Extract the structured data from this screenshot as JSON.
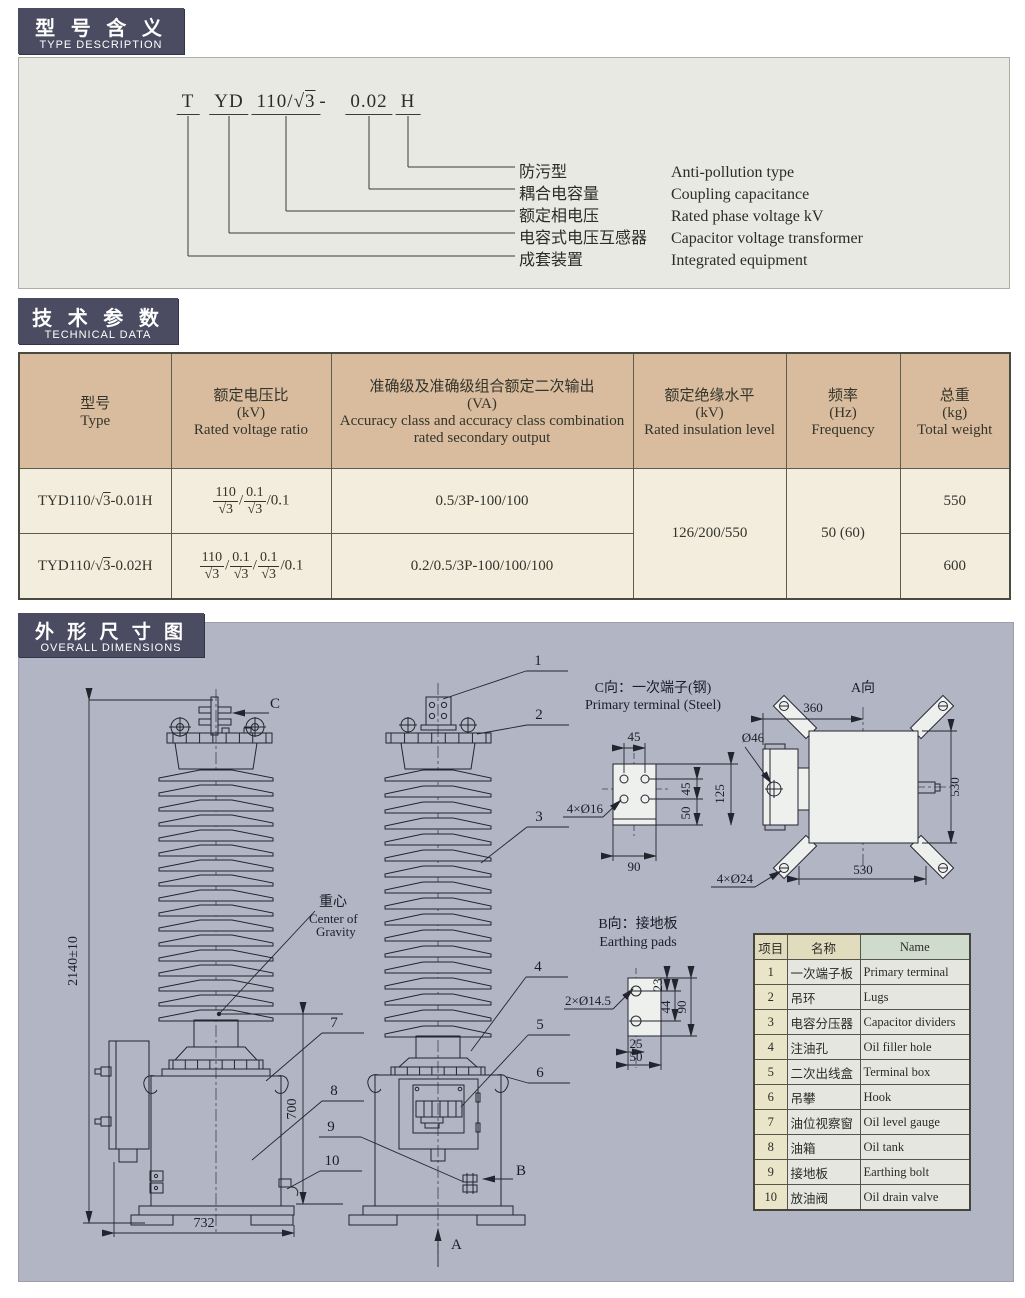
{
  "sections": {
    "type_desc": {
      "title_zh": "型 号 含 义",
      "title_en": "TYPE DESCRIPTION"
    },
    "tech": {
      "title_zh": "技 术 参 数",
      "title_en": "TECHNICAL DATA"
    },
    "dims": {
      "title_zh": "外 形 尺 寸 图",
      "title_en": "OVERALL DIMENSIONS"
    }
  },
  "type_code": {
    "tokens": [
      "T",
      "YD",
      "110/√3",
      "-",
      "0.02",
      "H"
    ],
    "meanings": [
      {
        "zh": "防污型",
        "en": "Anti-pollution type"
      },
      {
        "zh": "耦合电容量",
        "en": "Coupling capacitance"
      },
      {
        "zh": "额定相电压",
        "en": "Rated phase voltage kV"
      },
      {
        "zh": "电容式电压互感器",
        "en": "Capacitor voltage transformer"
      },
      {
        "zh": "成套装置",
        "en": "Integrated equipment"
      }
    ]
  },
  "tech_table": {
    "headers": [
      {
        "zh": "型号",
        "unit": "",
        "en": "Type"
      },
      {
        "zh": "额定电压比",
        "unit": "(kV)",
        "en": "Rated voltage ratio"
      },
      {
        "zh": "准确级及准确级组合额定二次输出",
        "unit": "(VA)",
        "en": "Accuracy class and accuracy class combination rated secondary output"
      },
      {
        "zh": "额定绝缘水平",
        "unit": "(kV)",
        "en": "Rated insulation level"
      },
      {
        "zh": "频率",
        "unit": "(Hz)",
        "en": "Frequency"
      },
      {
        "zh": "总重",
        "unit": "(kg)",
        "en": "Total weight"
      }
    ],
    "rows": [
      {
        "type": "TYD110/√3-0.01H",
        "ratio_tokens": [
          {
            "frac": [
              "110",
              "√3"
            ]
          },
          {
            "text": "/"
          },
          {
            "frac": [
              "0.1",
              "√3"
            ]
          },
          {
            "text": "/0.1"
          }
        ],
        "output": "0.5/3P-100/100",
        "weight": "550"
      },
      {
        "type": "TYD110/√3-0.02H",
        "ratio_tokens": [
          {
            "frac": [
              "110",
              "√3"
            ]
          },
          {
            "text": "/"
          },
          {
            "frac": [
              "0.1",
              "√3"
            ]
          },
          {
            "text": "/"
          },
          {
            "frac": [
              "0.1",
              "√3"
            ]
          },
          {
            "text": "/0.1"
          }
        ],
        "output": "0.2/0.5/3P-100/100/100",
        "weight": "600"
      }
    ],
    "insulation": "126/200/550",
    "frequency": "50 (60)"
  },
  "drawing": {
    "labels": {
      "c_title_zh": "C向：一次端子(钢)",
      "c_title_en": "Primary terminal (Steel)",
      "a_view": "A向",
      "b_title_zh": "B向：接地板",
      "b_title_en": "Earthing pads",
      "cg_zh": "重心",
      "cg_en1": "Center of",
      "cg_en2": "Gravity",
      "c_arrow": "C",
      "a_arrow": "A",
      "b_arrow": "B"
    },
    "dims": {
      "overall_height": "2140±10",
      "tank_height": "700",
      "base_width": "732",
      "c_top": "45",
      "c_bottom": "90",
      "c_v45": "45",
      "c_v50": "50",
      "c_v125": "125",
      "c_holes": "4×Ø16",
      "a_360": "360",
      "a_530r": "530",
      "a_530b": "530",
      "a_holes": "4×Ø24",
      "a_boss": "Ø46",
      "b_holes": "2×Ø14.5",
      "b_23": "23",
      "b_44": "44",
      "b_90": "90",
      "b_25": "25",
      "b_50": "50"
    },
    "callouts": [
      "1",
      "2",
      "3",
      "4",
      "5",
      "6",
      "7",
      "8",
      "9",
      "10"
    ]
  },
  "parts_table": {
    "headers": {
      "col1": "项目",
      "col2": "名称",
      "col3": "Name"
    },
    "rows": [
      {
        "no": "1",
        "zh": "一次端子板",
        "en": "Primary terminal"
      },
      {
        "no": "2",
        "zh": "吊环",
        "en": "Lugs"
      },
      {
        "no": "3",
        "zh": "电容分压器",
        "en": "Capacitor dividers"
      },
      {
        "no": "4",
        "zh": "注油孔",
        "en": "Oil filler hole"
      },
      {
        "no": "5",
        "zh": "二次出线盒",
        "en": "Terminal box"
      },
      {
        "no": "6",
        "zh": "吊攀",
        "en": "Hook"
      },
      {
        "no": "7",
        "zh": "油位视察窗",
        "en": "Oil level gauge"
      },
      {
        "no": "8",
        "zh": "油箱",
        "en": "Oil tank"
      },
      {
        "no": "9",
        "zh": "接地板",
        "en": "Earthing bolt"
      },
      {
        "no": "10",
        "zh": "放油阀",
        "en": "Oil drain valve"
      }
    ]
  },
  "colors": {
    "badge": "#4b4b61",
    "table_header": "#d9bc9d",
    "table_body": "#f2eddc",
    "panel_type": "#e8e9e2",
    "panel_drawing": "#b2b6c4"
  }
}
